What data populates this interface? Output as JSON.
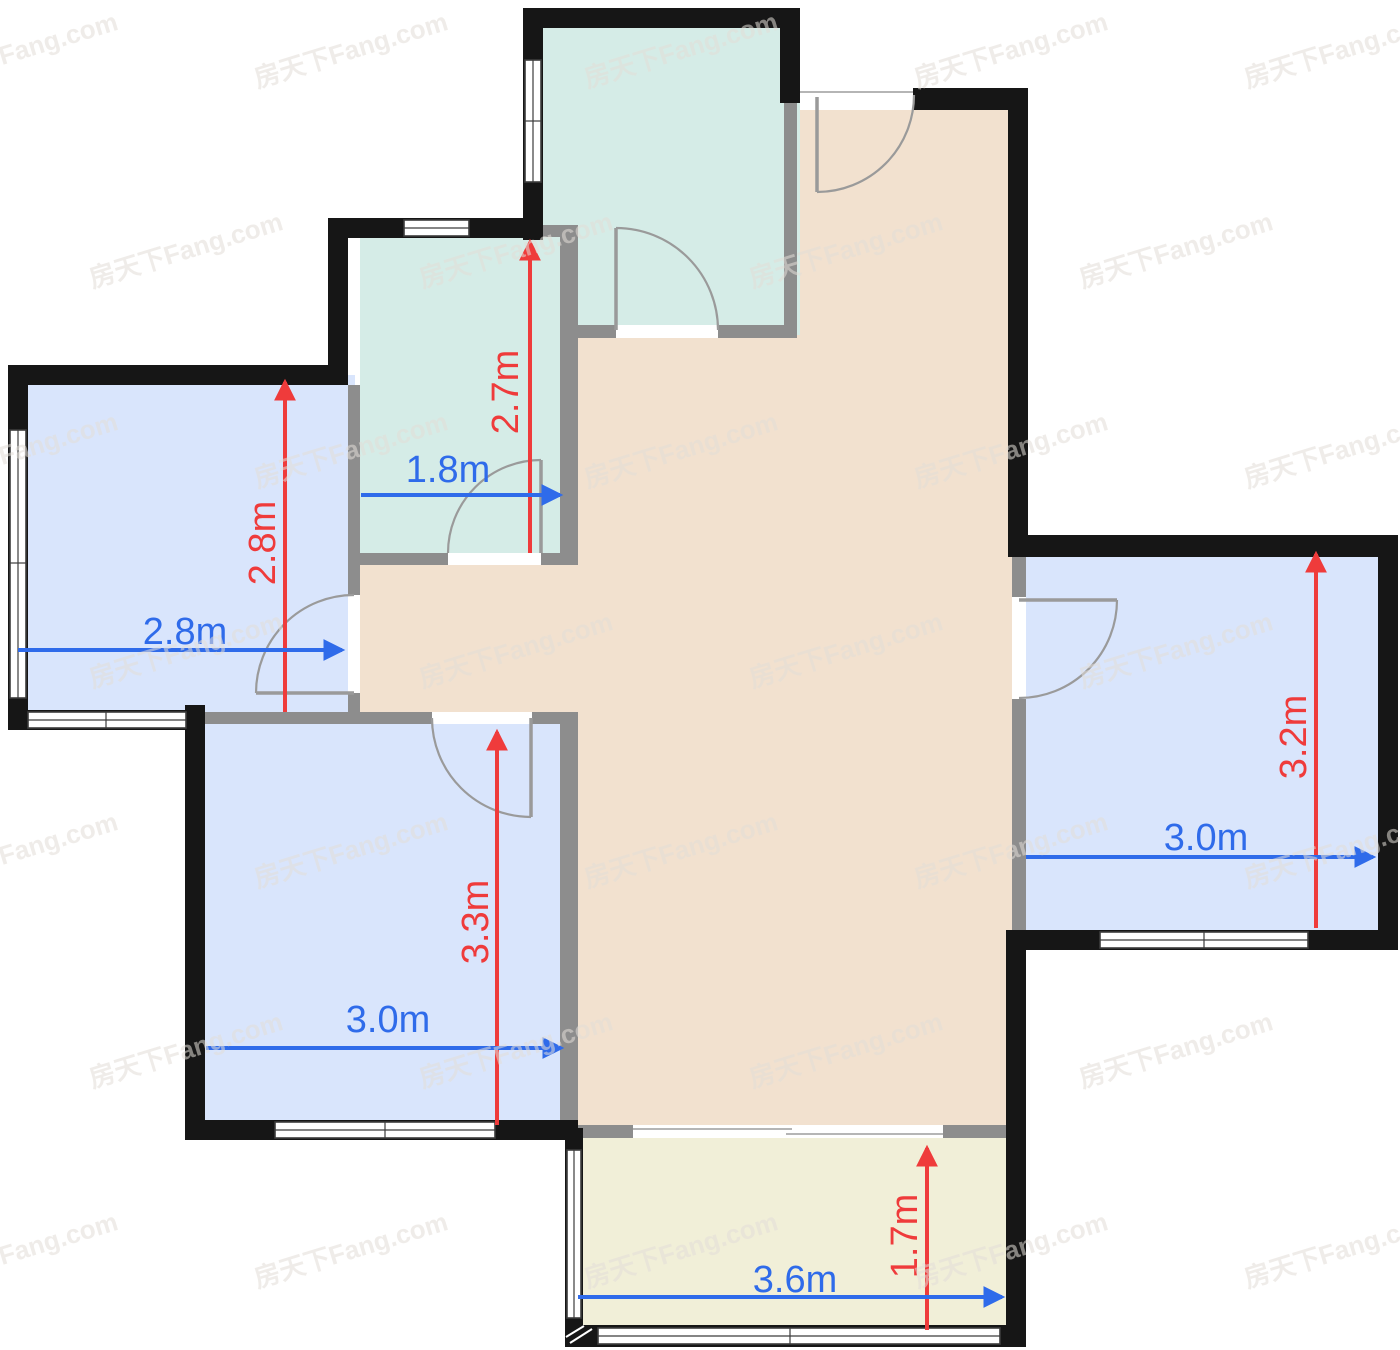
{
  "watermark": {
    "text": "房天下Fang.com"
  },
  "colors": {
    "wall": "#161616",
    "inner_wall": "#8d8d8d",
    "door_arc": "#9a9a9a",
    "living": "#f2e1cf",
    "bath": "#d5ece7",
    "bedroom": "#d9e5fc",
    "balcony": "#f1efd8",
    "dim_red": "#ef3b3b",
    "dim_blue": "#2f6bea",
    "watermark_color": "#e3ded8"
  },
  "dimensions": {
    "bath_small": {
      "width": "1.8m",
      "height": "2.7m"
    },
    "bedroom_left": {
      "width": "2.8m",
      "height": "2.8m"
    },
    "bedroom_lower_left": {
      "width": "3.0m",
      "height": "3.3m"
    },
    "bedroom_right": {
      "width": "3.0m",
      "height": "3.2m"
    },
    "balcony": {
      "width": "3.6m",
      "height": "1.7m"
    }
  }
}
